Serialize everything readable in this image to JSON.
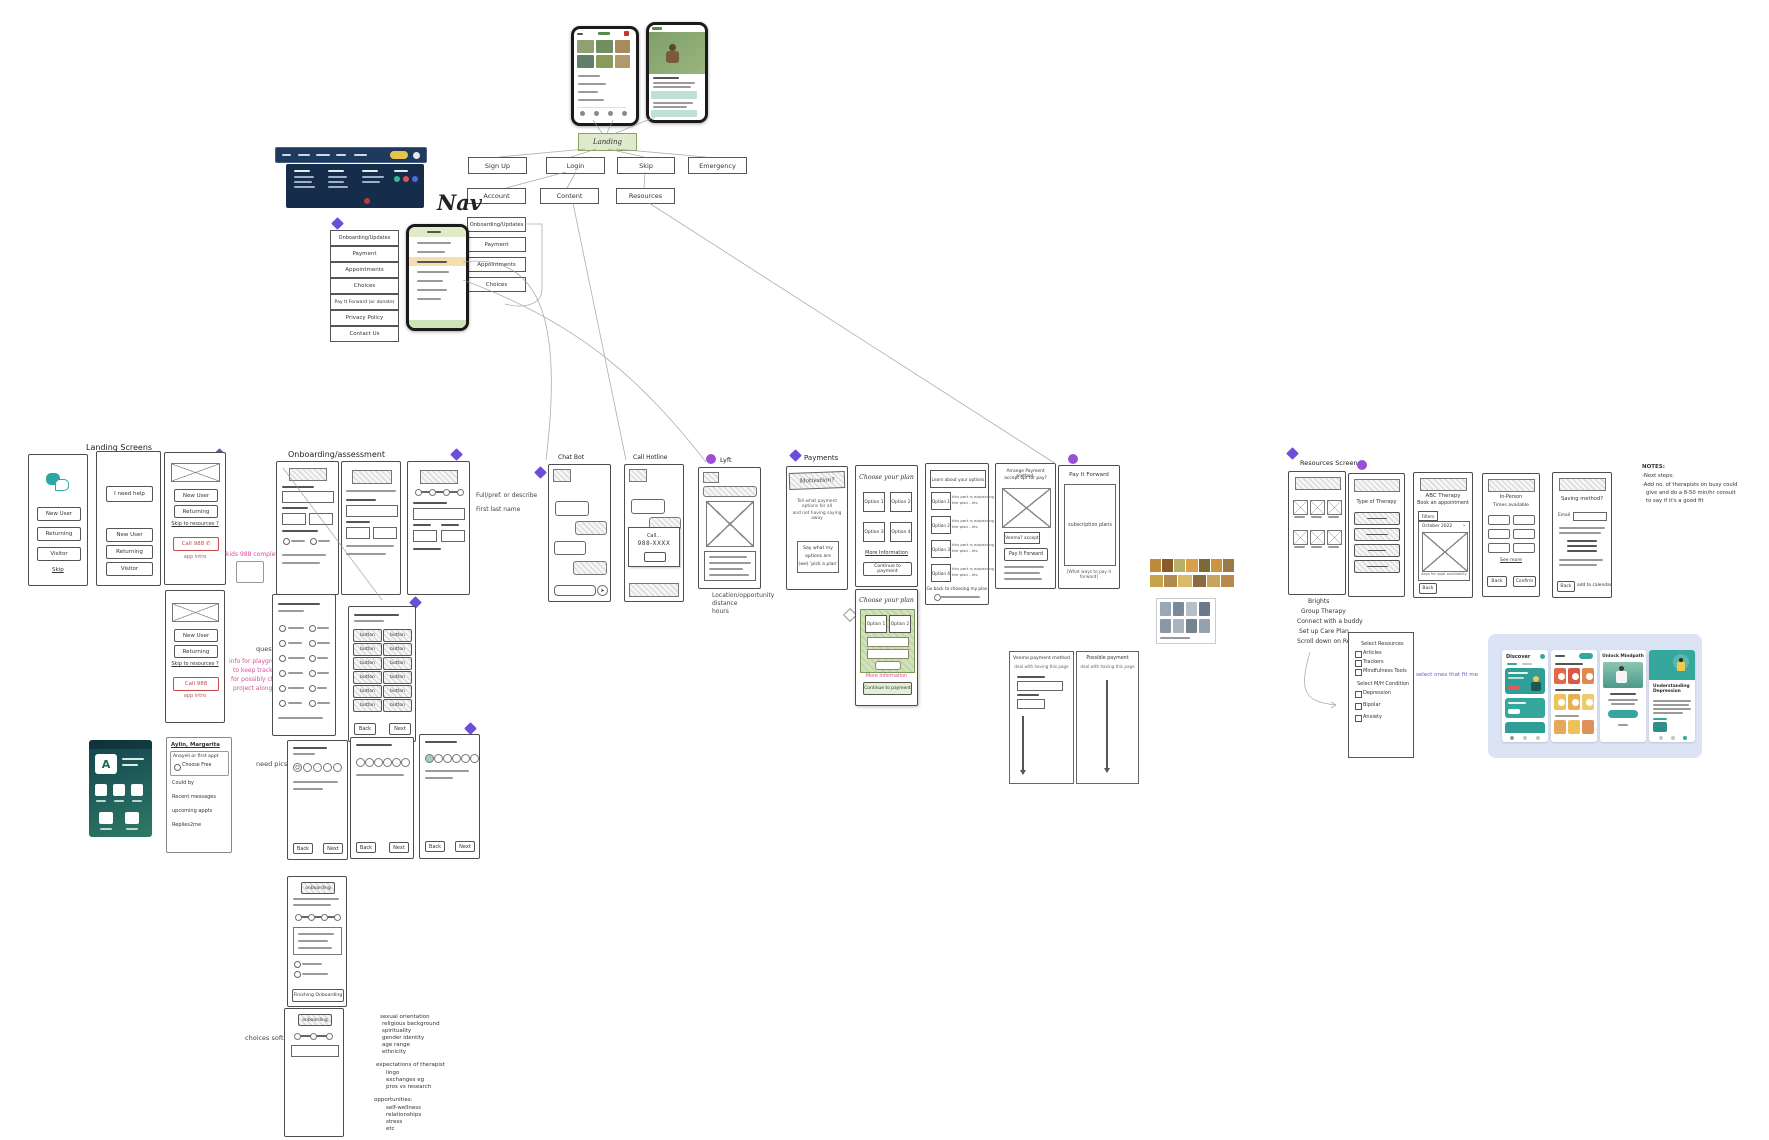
{
  "flow": {
    "landing_label": "Landing",
    "nav_label": "Nav",
    "row1": [
      "Sign Up",
      "Login",
      "Skip",
      "Emergency"
    ],
    "row2": [
      "Account",
      "Content",
      "Resources"
    ],
    "account_children": [
      "Onboarding/Updates",
      "Payment",
      "Appointments",
      "Choices"
    ]
  },
  "menu": {
    "items": [
      "Onboarding/Updates",
      "Payment",
      "Appointments",
      "Choices",
      "Pay It Forward (or donate)",
      "Privacy Policy",
      "Contact Us"
    ]
  },
  "landing_screens": {
    "title": "Landing Screens",
    "new_user": "New User",
    "returning": "Returning",
    "visitor": "Visitor",
    "skip": "Skip",
    "need_help": "I need help",
    "skip_resources": "Skip to resources ?",
    "call_988": "Call 988",
    "app_intro": "app intro",
    "pink_note": "kids 988 completely"
  },
  "onboarding": {
    "title": "Onboarding/assessment",
    "annotation1": "Full/pref. or describe",
    "annotation2": "First last name",
    "questions_label": "questions",
    "pink_note1": "info for playground",
    "pink_note2": "to keep track;",
    "pink_note3": "for possibly change",
    "pink_note4": "project along etc",
    "button": "button",
    "back": "Back",
    "next": "Next",
    "need_pics": "need pics?",
    "pill": "onboarding",
    "finish": "Finishing Onboarding",
    "choices_label": "choices software"
  },
  "identity": {
    "block1": [
      "sexual orientation",
      "religious background",
      "spirituality",
      "gender identity",
      "age range",
      "ethnicity"
    ],
    "block2_title": "expectations of therapist",
    "block2": [
      "lingo",
      "exchanges eg",
      "pros vs research"
    ],
    "block3_title": "opportunities:",
    "block3": [
      "self-wellness",
      "relationships",
      "stress",
      "etc"
    ]
  },
  "account_card": {
    "lines": [
      "Aylin, Margarita",
      "Anayeli or first appt",
      "Choose Free",
      "Could by",
      "Recent messages",
      "upcoming appts",
      "Replies2me"
    ],
    "app_letter": "A"
  },
  "chat": {
    "chat_bot_title": "Chat Bot",
    "call_hotline_title": "Call Hotline",
    "modal_call": "Call...",
    "modal_number": "988-XXXX"
  },
  "lyft": {
    "title": "Lyft",
    "caption": [
      "Location/opportunity",
      "distance",
      "hours"
    ]
  },
  "payments": {
    "title": "Payments",
    "motivation_title": "Motivation?",
    "motivation_text1": "Tell what payment options for all",
    "motivation_text2": "and not having saying away",
    "say_box": [
      "Say what my",
      "options are",
      "(we) 'pick a plan'"
    ],
    "choose_title": "Choose your plan",
    "options": [
      "Option 1",
      "Option 2",
      "Option 3",
      "Option 4"
    ],
    "more_info": "More Information",
    "continue": "Continue to payment",
    "learn_title": "Learn about your options",
    "option_desc1": "this part is explaining",
    "option_desc2": "the plan - etc",
    "go_back": "Go back to choosing my plan",
    "arrange1": "Arrange Payment method,",
    "arrange2": "accept opt for pay?",
    "venmo_accept": "Venmo? accept",
    "pay_it_forward": "Pay It Forward",
    "subscription": "subscription plans",
    "ways": "[What ways to pay it forward]",
    "venmo_method_title": "Venmo payment method",
    "possible_title": "Possible payment",
    "deal_text": "deal with having this page"
  },
  "resources": {
    "title": "Resources Screens",
    "type_of_therapy": "Type of Therapy",
    "abc": "ABC Therapy",
    "book": "Book an appointment",
    "filters": "Filters",
    "month": "October 2022",
    "days_caption": "days for appt availability",
    "back": "Back",
    "in_person": "In-Person",
    "times": "Times available",
    "see_more": "See more",
    "confirm": "Confirm",
    "saving": "Saving method?",
    "email": "Email",
    "add_cal": "add to calendar",
    "notes": [
      "NOTES:",
      "-Next steps:",
      "-Add no. of therapists on busy could",
      "give and do a 8-50 min/hr consult",
      "to say if it's a good fit"
    ],
    "flow_notes": [
      "Brights",
      "Group Therapy",
      "Connect with a buddy",
      "Set up Care Plan",
      "Scroll down on Resources"
    ],
    "checklist_title1": "Select Resources",
    "check1": [
      "Articles",
      "Trackers",
      "Mindfulness Tools"
    ],
    "checklist_title2": "Select M/H Condition",
    "check2": [
      "Depression",
      "Bipolar",
      "Anxiety"
    ],
    "purple_note": "select ones that fit me"
  },
  "app_panel": {
    "discover": "Discover",
    "unlock": "Unlock Mindpath",
    "understanding": "Understanding Depression"
  },
  "icons": {
    "chevron": "›",
    "play": "▶",
    "send": "➤",
    "phone": "✆",
    "smiley": "☺"
  },
  "colors": {
    "accent_purple": "#6e4ed6",
    "teal": "#35a79c",
    "landing_green": "#dfeac7",
    "call_red": "#c84a4a",
    "navy": "#1e3a5f",
    "pink": "#d4509e"
  }
}
